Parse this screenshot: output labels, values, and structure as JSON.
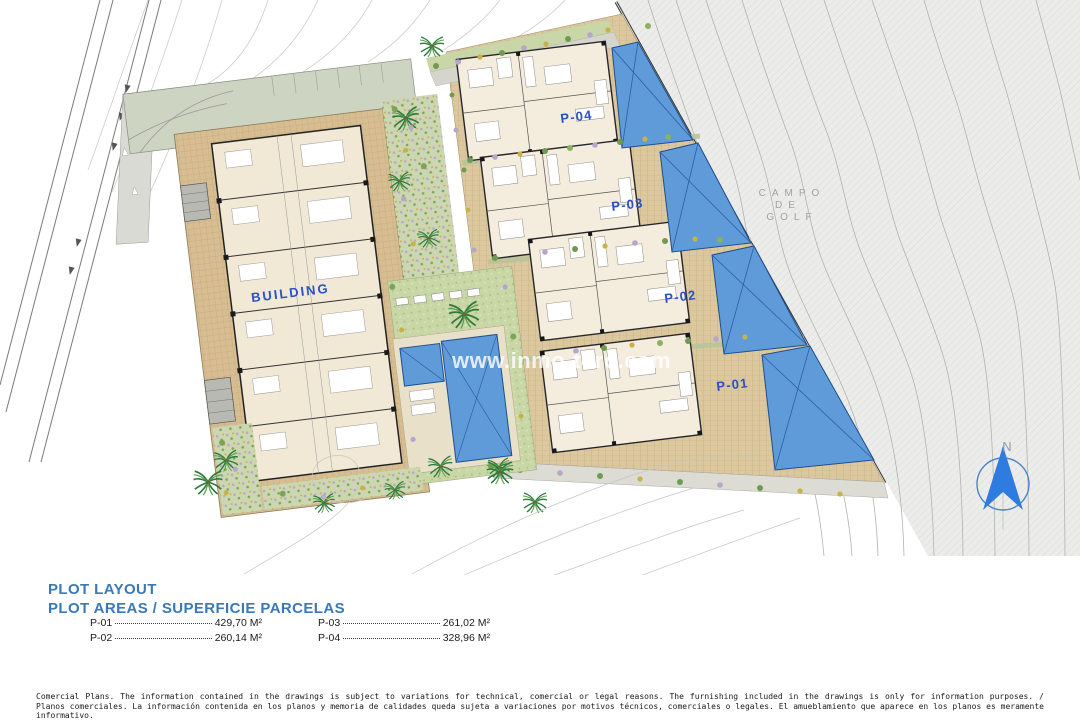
{
  "plan": {
    "watermark": "www.inmo-toro.com",
    "building_label": "BUILDING",
    "golf_label": {
      "line1": "CAMPO",
      "line2": "DE",
      "line3": "GOLF"
    },
    "north_label": "N",
    "plots": [
      {
        "id": "P-04"
      },
      {
        "id": "P-03"
      },
      {
        "id": "P-02"
      },
      {
        "id": "P-01"
      }
    ]
  },
  "legend": {
    "title": "PLOT LAYOUT",
    "subtitle": "PLOT AREAS / SUPERFICIE PARCELAS",
    "entries": [
      {
        "label": "P-01",
        "area": "429,70 M²"
      },
      {
        "label": "P-02",
        "area": "260,14 M²"
      },
      {
        "label": "P-03",
        "area": "261,02 M²"
      },
      {
        "label": "P-04",
        "area": "328,96 M²"
      }
    ]
  },
  "disclaimer": {
    "line1": "Comercial Plans. The information contained in the drawings is subject to variations for technical, comercial or legal reasons. The furnishing included in the drawings is only for information purposes. /",
    "line2": "Planos comerciales. La información contenida en los planos y memoria de calidades queda sujeta a variaciones por motivos técnicos, comerciales o legales. El amueblamiento que aparece en los planos es meramente",
    "line3": "informativo."
  },
  "colors": {
    "heading_blue": "#3b79b6",
    "label_blue": "#2b50c8",
    "pool_blue": "#5f9bd8",
    "plot_tan": "#dcc89e",
    "lawn_green": "#c9d6a6",
    "golf_gray": "#ececea",
    "sage": "#cdd4c2"
  }
}
